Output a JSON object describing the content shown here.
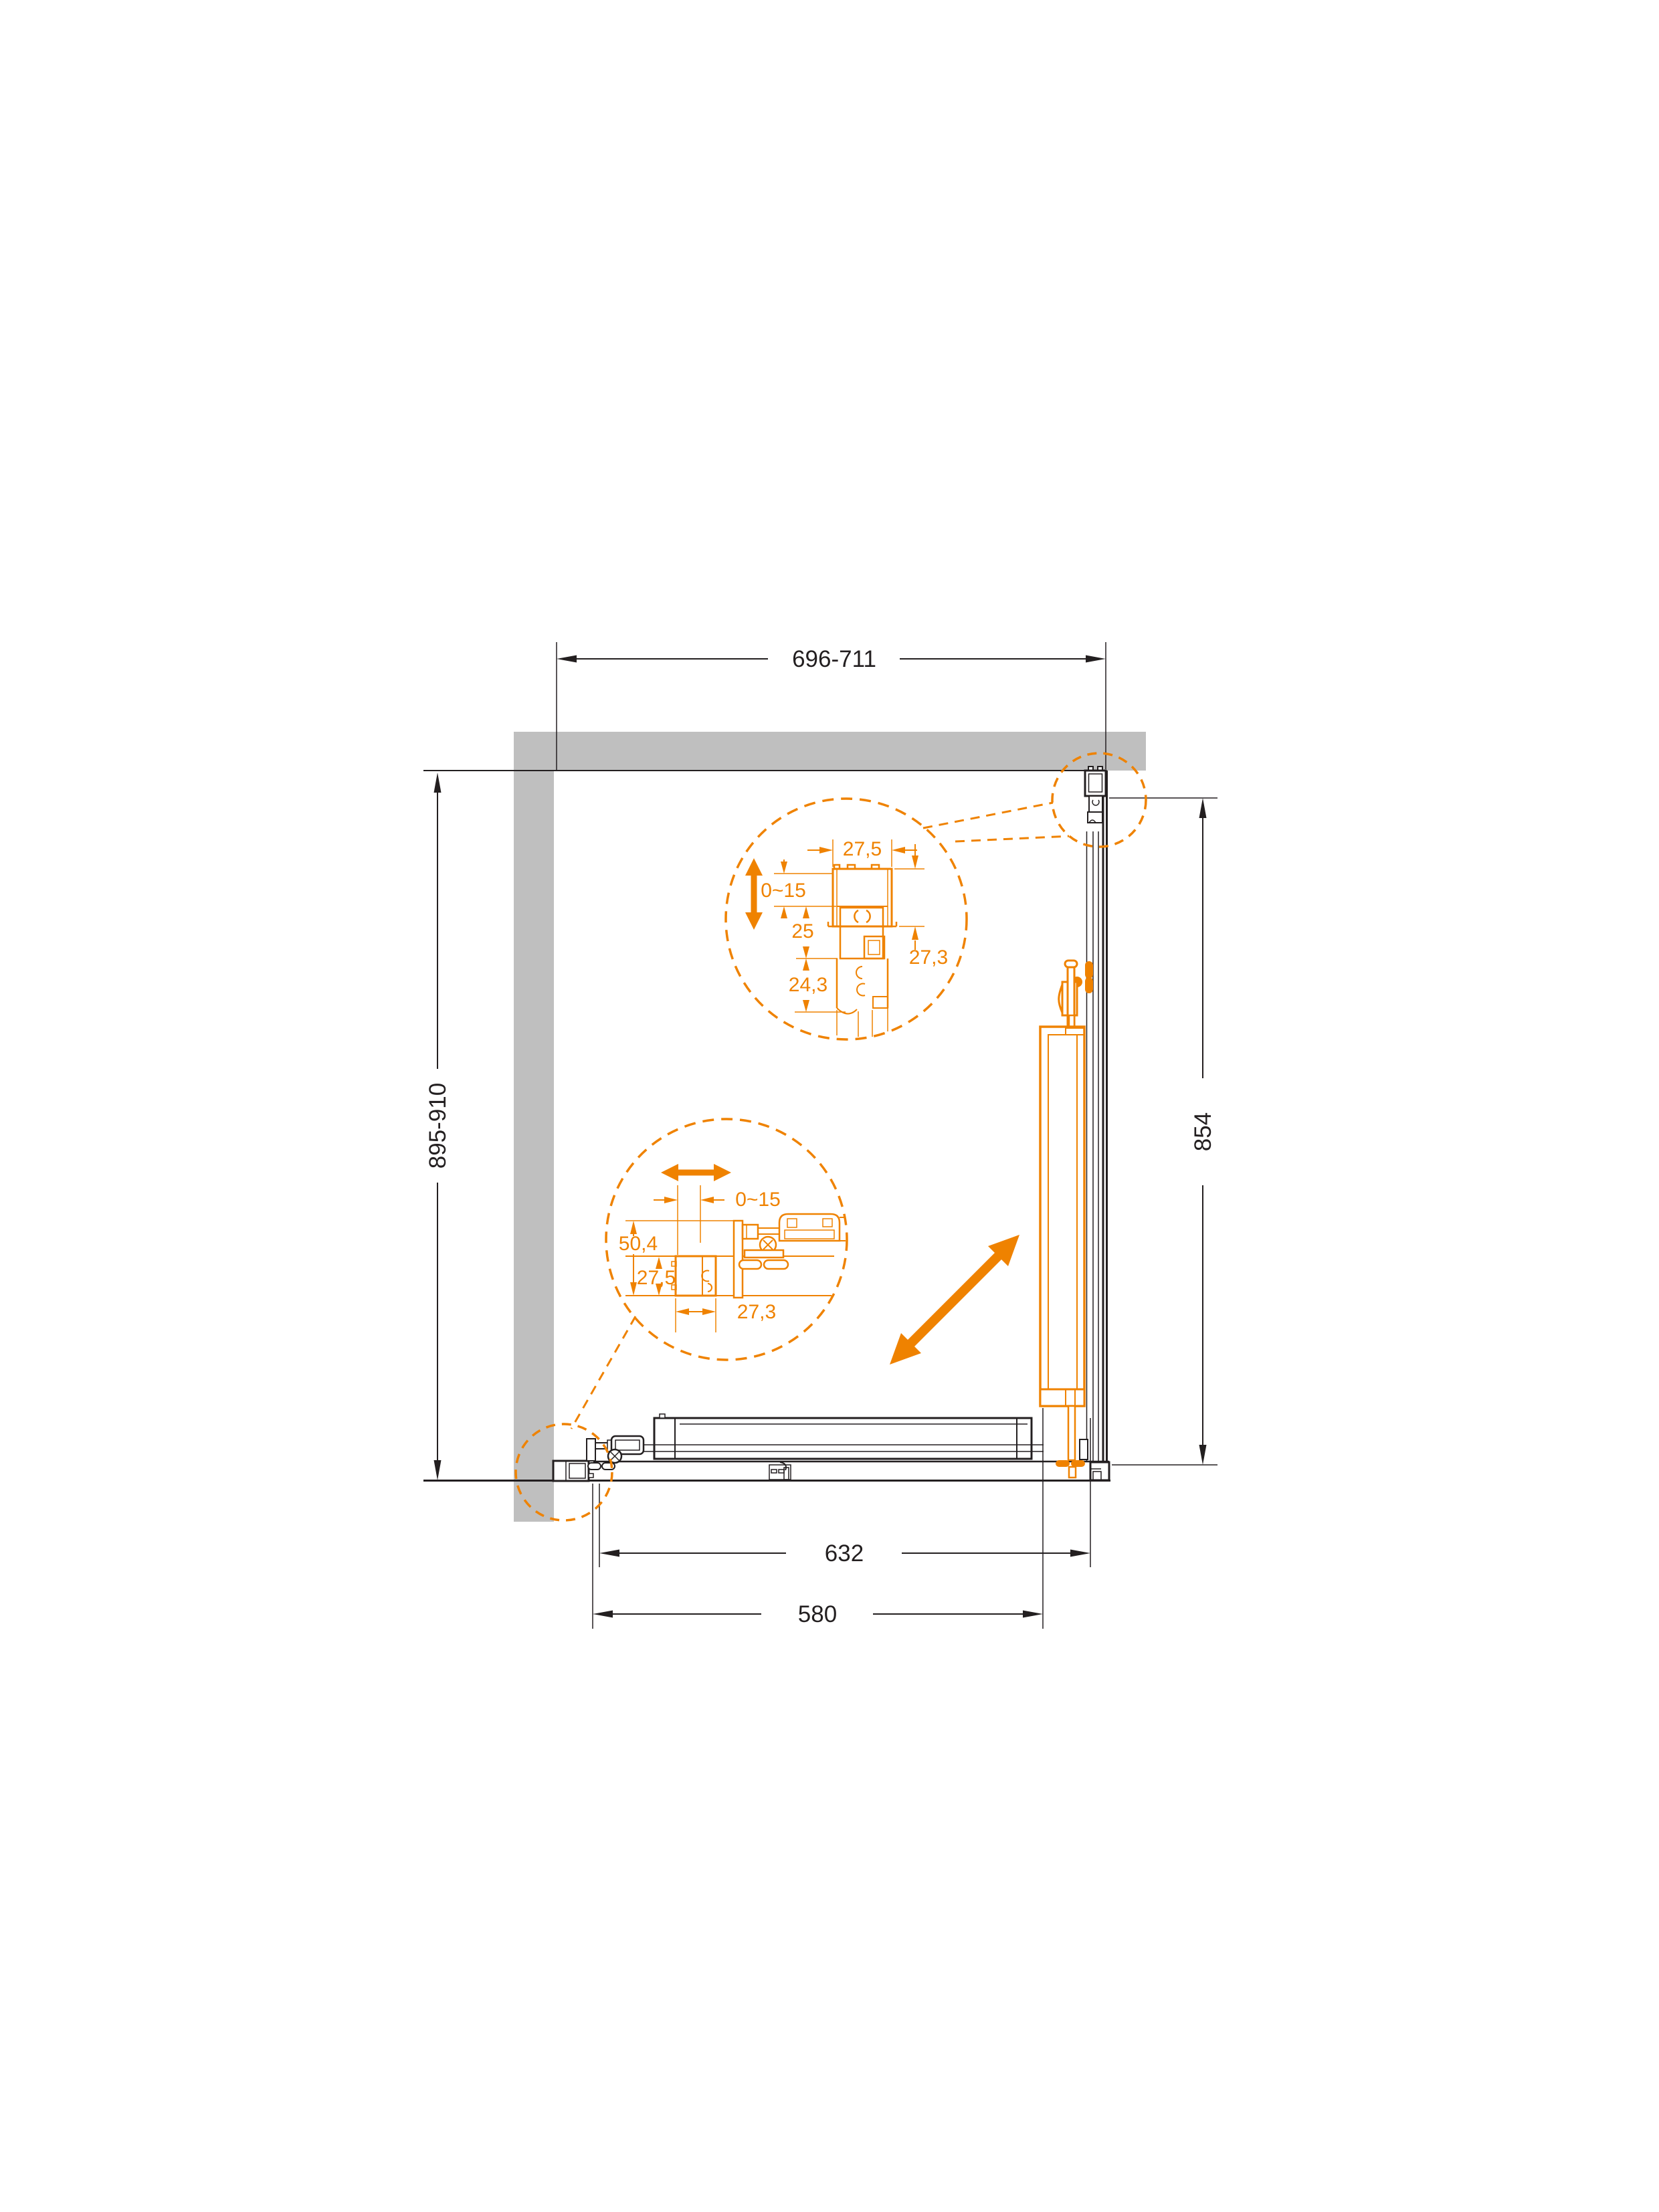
{
  "drawing": {
    "type": "shower-enclosure-plan-technical-drawing",
    "units": "mm",
    "colors": {
      "accent_orange": "#ef8200",
      "wall_gray": "#bfbfbf",
      "line_dark": "#231f20"
    },
    "dimensions": {
      "top_width": "696-711",
      "left_depth": "895-910",
      "right_height": "854",
      "bottom_track_width": "632",
      "bottom_glass_width": "580"
    },
    "detail_top": {
      "profile_width": "27,5",
      "adjustment_range": "0~15",
      "upper_inset": "25",
      "lower_inset": "24,3",
      "profile_depth": "27,3"
    },
    "detail_bottom": {
      "adjustment_range": "0~15",
      "assembly_height": "50,4",
      "profile_height": "27,5",
      "profile_width": "27,3"
    },
    "icons": {
      "slide_direction": "diagonal-double-arrow",
      "adjust_vertical": "vertical-double-arrow",
      "adjust_horizontal": "horizontal-double-arrow"
    }
  }
}
